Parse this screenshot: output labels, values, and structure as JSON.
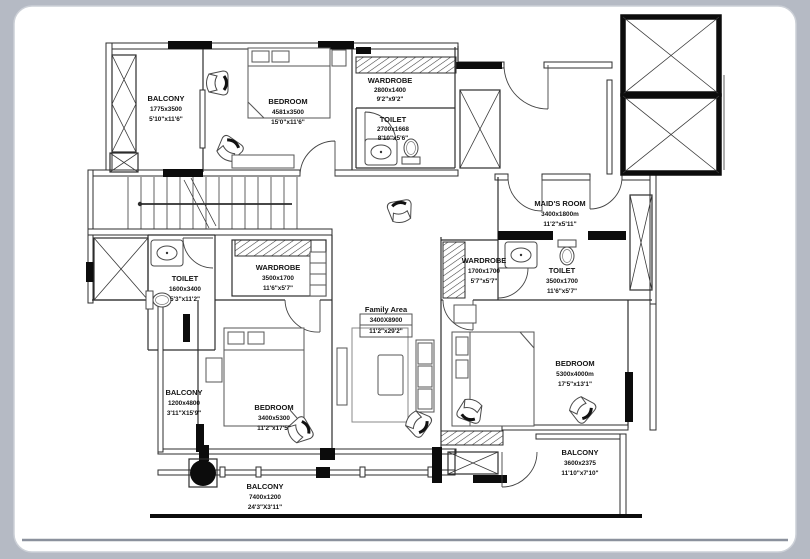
{
  "page": {
    "background_color": "#b5bac4",
    "card_color": "#ffffff",
    "wall_color": "#2d2d2d",
    "accent_black": "#0c0c0c"
  },
  "rooms": [
    {
      "id": "balcony-top-left",
      "name": "BALCONY",
      "mm": "1775x3500",
      "ft": "5'10\"x11'6\""
    },
    {
      "id": "bedroom-top-left",
      "name": "BEDROOM",
      "mm": "4581x3500",
      "ft": "15'0\"x11'6\""
    },
    {
      "id": "wardrobe-top",
      "name": "WARDROBE",
      "mm": "2800x1400",
      "ft": "9'2\"x9'2\""
    },
    {
      "id": "toilet-top",
      "name": "TOILET",
      "mm": "2700x1668",
      "ft": "8'10\"x5'6\""
    },
    {
      "id": "maids-room",
      "name": "MAID'S ROOM",
      "mm": "3400x1800m",
      "ft": "11'2\"x5'11\""
    },
    {
      "id": "toilet-right",
      "name": "TOILET",
      "mm": "3500x1700",
      "ft": "11'6\"x5'7\""
    },
    {
      "id": "wardrobe-left",
      "name": "WARDROBE",
      "mm": "3500x1700",
      "ft": "11'6\"x5'7\""
    },
    {
      "id": "toilet-left",
      "name": "TOILET",
      "mm": "1600x3400",
      "ft": "5'3\"x11'2\""
    },
    {
      "id": "wardrobe-mid",
      "name": "WARDROBE",
      "mm": "1700x1700",
      "ft": "5'7\"x5'7\""
    },
    {
      "id": "family-area",
      "name": "Family Area",
      "mm": "3400X8900",
      "ft": "11'2\"x29'2\""
    },
    {
      "id": "balcony-left",
      "name": "BALCONY",
      "mm": "1200x4800",
      "ft": "3'11\"X15'9\""
    },
    {
      "id": "bedroom-bottom",
      "name": "BEDROOM",
      "mm": "3400x5300",
      "ft": "11'2\"x17'5\""
    },
    {
      "id": "balcony-bottom",
      "name": "BALCONY",
      "mm": "7400x1200",
      "ft": "24'3\"X3'11\""
    },
    {
      "id": "bedroom-right",
      "name": "BEDROOM",
      "mm": "5300x4000m",
      "ft": "17'5\"x13'1\""
    },
    {
      "id": "balcony-bottom-right",
      "name": "BALCONY",
      "mm": "3600x2375",
      "ft": "11'10\"x7'10\""
    }
  ]
}
